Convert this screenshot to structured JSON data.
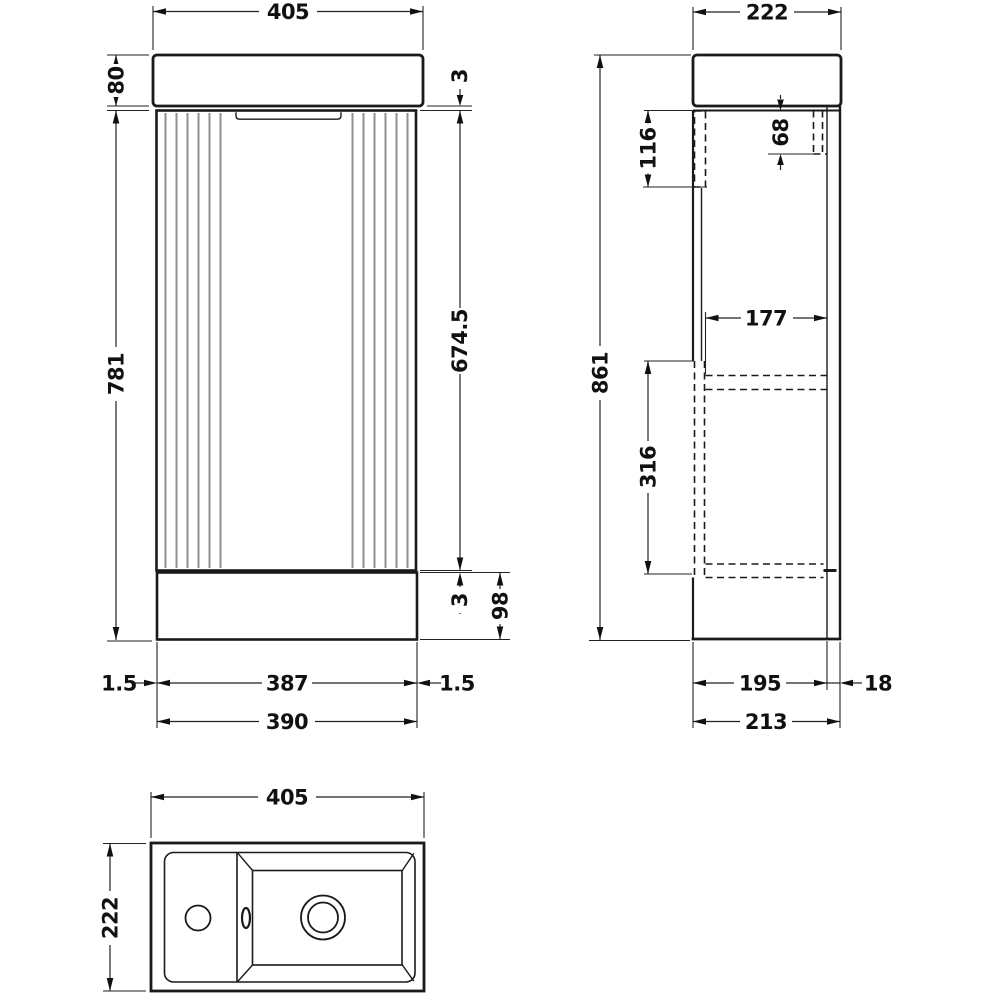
{
  "drawing": {
    "type": "vanity-unit-technical-drawing",
    "views": {
      "front": "front-elevation",
      "side": "side-elevation",
      "plan": "plan-view-basin"
    }
  },
  "dimensions": {
    "front": {
      "overall_width": "405",
      "basin_height": "80",
      "cabinet_height": "781",
      "top_gap": "3",
      "door_height": "674.5",
      "bottom_gap": "3",
      "plinth_height": "98",
      "inset_left": "1.5",
      "door_width": "387",
      "inset_right": "1.5",
      "cabinet_width": "390"
    },
    "side": {
      "basin_depth": "222",
      "hinge_plate_height": "116",
      "bracket_height": "68",
      "overall_height": "861",
      "shelf_depth": "177",
      "lower_section_height": "316",
      "internal_depth": "195",
      "back_panel_thickness": "18",
      "cabinet_depth": "213"
    },
    "plan": {
      "overall_width": "405",
      "overall_depth": "222"
    }
  }
}
